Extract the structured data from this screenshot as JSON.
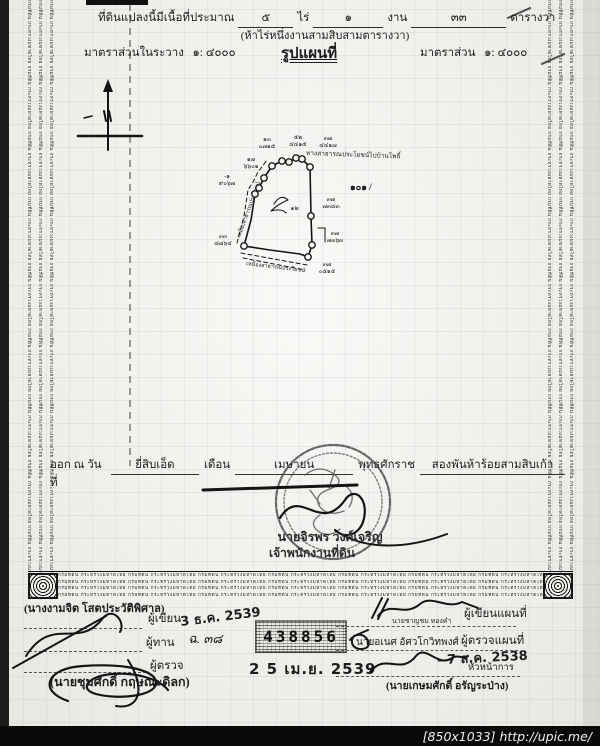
{
  "page": {
    "watermark": "[850x1033] http://upic.me/",
    "security_text": "กรมที่ดิน กระทรวงมหาดไทย",
    "serial_number": "438856"
  },
  "header": {
    "area_prefix": "ที่ดินแปลงนี้มีเนื้อที่ประมาณ",
    "rai_value": "๕",
    "rai_label": "ไร่",
    "ngan_value": "๑",
    "ngan_label": "งาน",
    "wa_value": "๓๓",
    "wa_label": "ตารางวา",
    "area_words": "(ห้าไร่หนึ่งงานสามสิบสามตารางวา)",
    "scale_sheet_label": "มาตราส่วนในระวาง",
    "scale_sheet_value": "๑: ๔๐๐๐",
    "map_title": "รูปแผนที่",
    "scale_label": "มาตราส่วน",
    "scale_value": "๑: ๔๐๐๐"
  },
  "map": {
    "parcel_number": "๑๐๑ /",
    "inner_mark": "๑๒",
    "road_top": "ทางสาธารณประโยชน์ไปบ้านโพธิ์",
    "road_left": "เหมืองสาธารณประโยชน์",
    "road_bottom": "เหมืองสาธารณประโยชน์",
    "markers": [
      {
        "id": "๑๓",
        "num": "๐๗๑๕"
      },
      {
        "id": "๑๗",
        "num": "๖๖๐๑"
      },
      {
        "id": "-๑",
        "num": "๙๐๖๗"
      },
      {
        "id": "๕๒",
        "num": "๔๔๑๕"
      },
      {
        "id": "๓๗",
        "num": "๔๔๑๗"
      },
      {
        "id": "๓๗",
        "num": "๗๓๘๓"
      },
      {
        "id": "๓๗",
        "num": "๗๓๖๓"
      },
      {
        "id": "๓๗",
        "num": "๐๕๑๕"
      },
      {
        "id": "๓๓",
        "num": "๘๗๖๔"
      }
    ]
  },
  "issue": {
    "prefix": "ออก ณ วันที่",
    "day_value": "ยี่สิบเอ็ด",
    "month_label": "เดือน",
    "month_value": "เมษายน",
    "era_label": "พุทธศักราช",
    "year_value": "สองพันห้าร้อยสามสิบเก้า"
  },
  "seal": {
    "officer_name": "นายจิรพร วงศ์เจริญ",
    "officer_title": "เจ้าพนักงานที่ดิน"
  },
  "left_block": {
    "writer_name": "(นางงามจิต โสตประวัติพิศาล)",
    "writer_label": "ผู้เขียน",
    "writer_stamp": "3 ธ.ค. 2539",
    "checker_label": "ผู้ทาน",
    "checker_note": "ฉ. ๓๘",
    "inspector_label": "ผู้ตรวจ",
    "inspector_name": "(นายชุมศักดิ์ กฤษณะดิลก)",
    "date_stamp": "2 5 เม.ย. 2539"
  },
  "right_block": {
    "map_writer_name": "นายชาญชม ทองคำ",
    "map_writer_label": "ผู้เขียนแผนที่",
    "map_inspector_name": "นายอเนศ อัศวโกวิทพงศ์",
    "map_inspector_label": "ผู้ตรวจแผนที่",
    "head_stamp": "- 7 ส.ค. 2538",
    "head_label": "หัวหน้าการ",
    "head_name": "(นายเกษมศักดิ์ อรัญระป่าง)"
  }
}
